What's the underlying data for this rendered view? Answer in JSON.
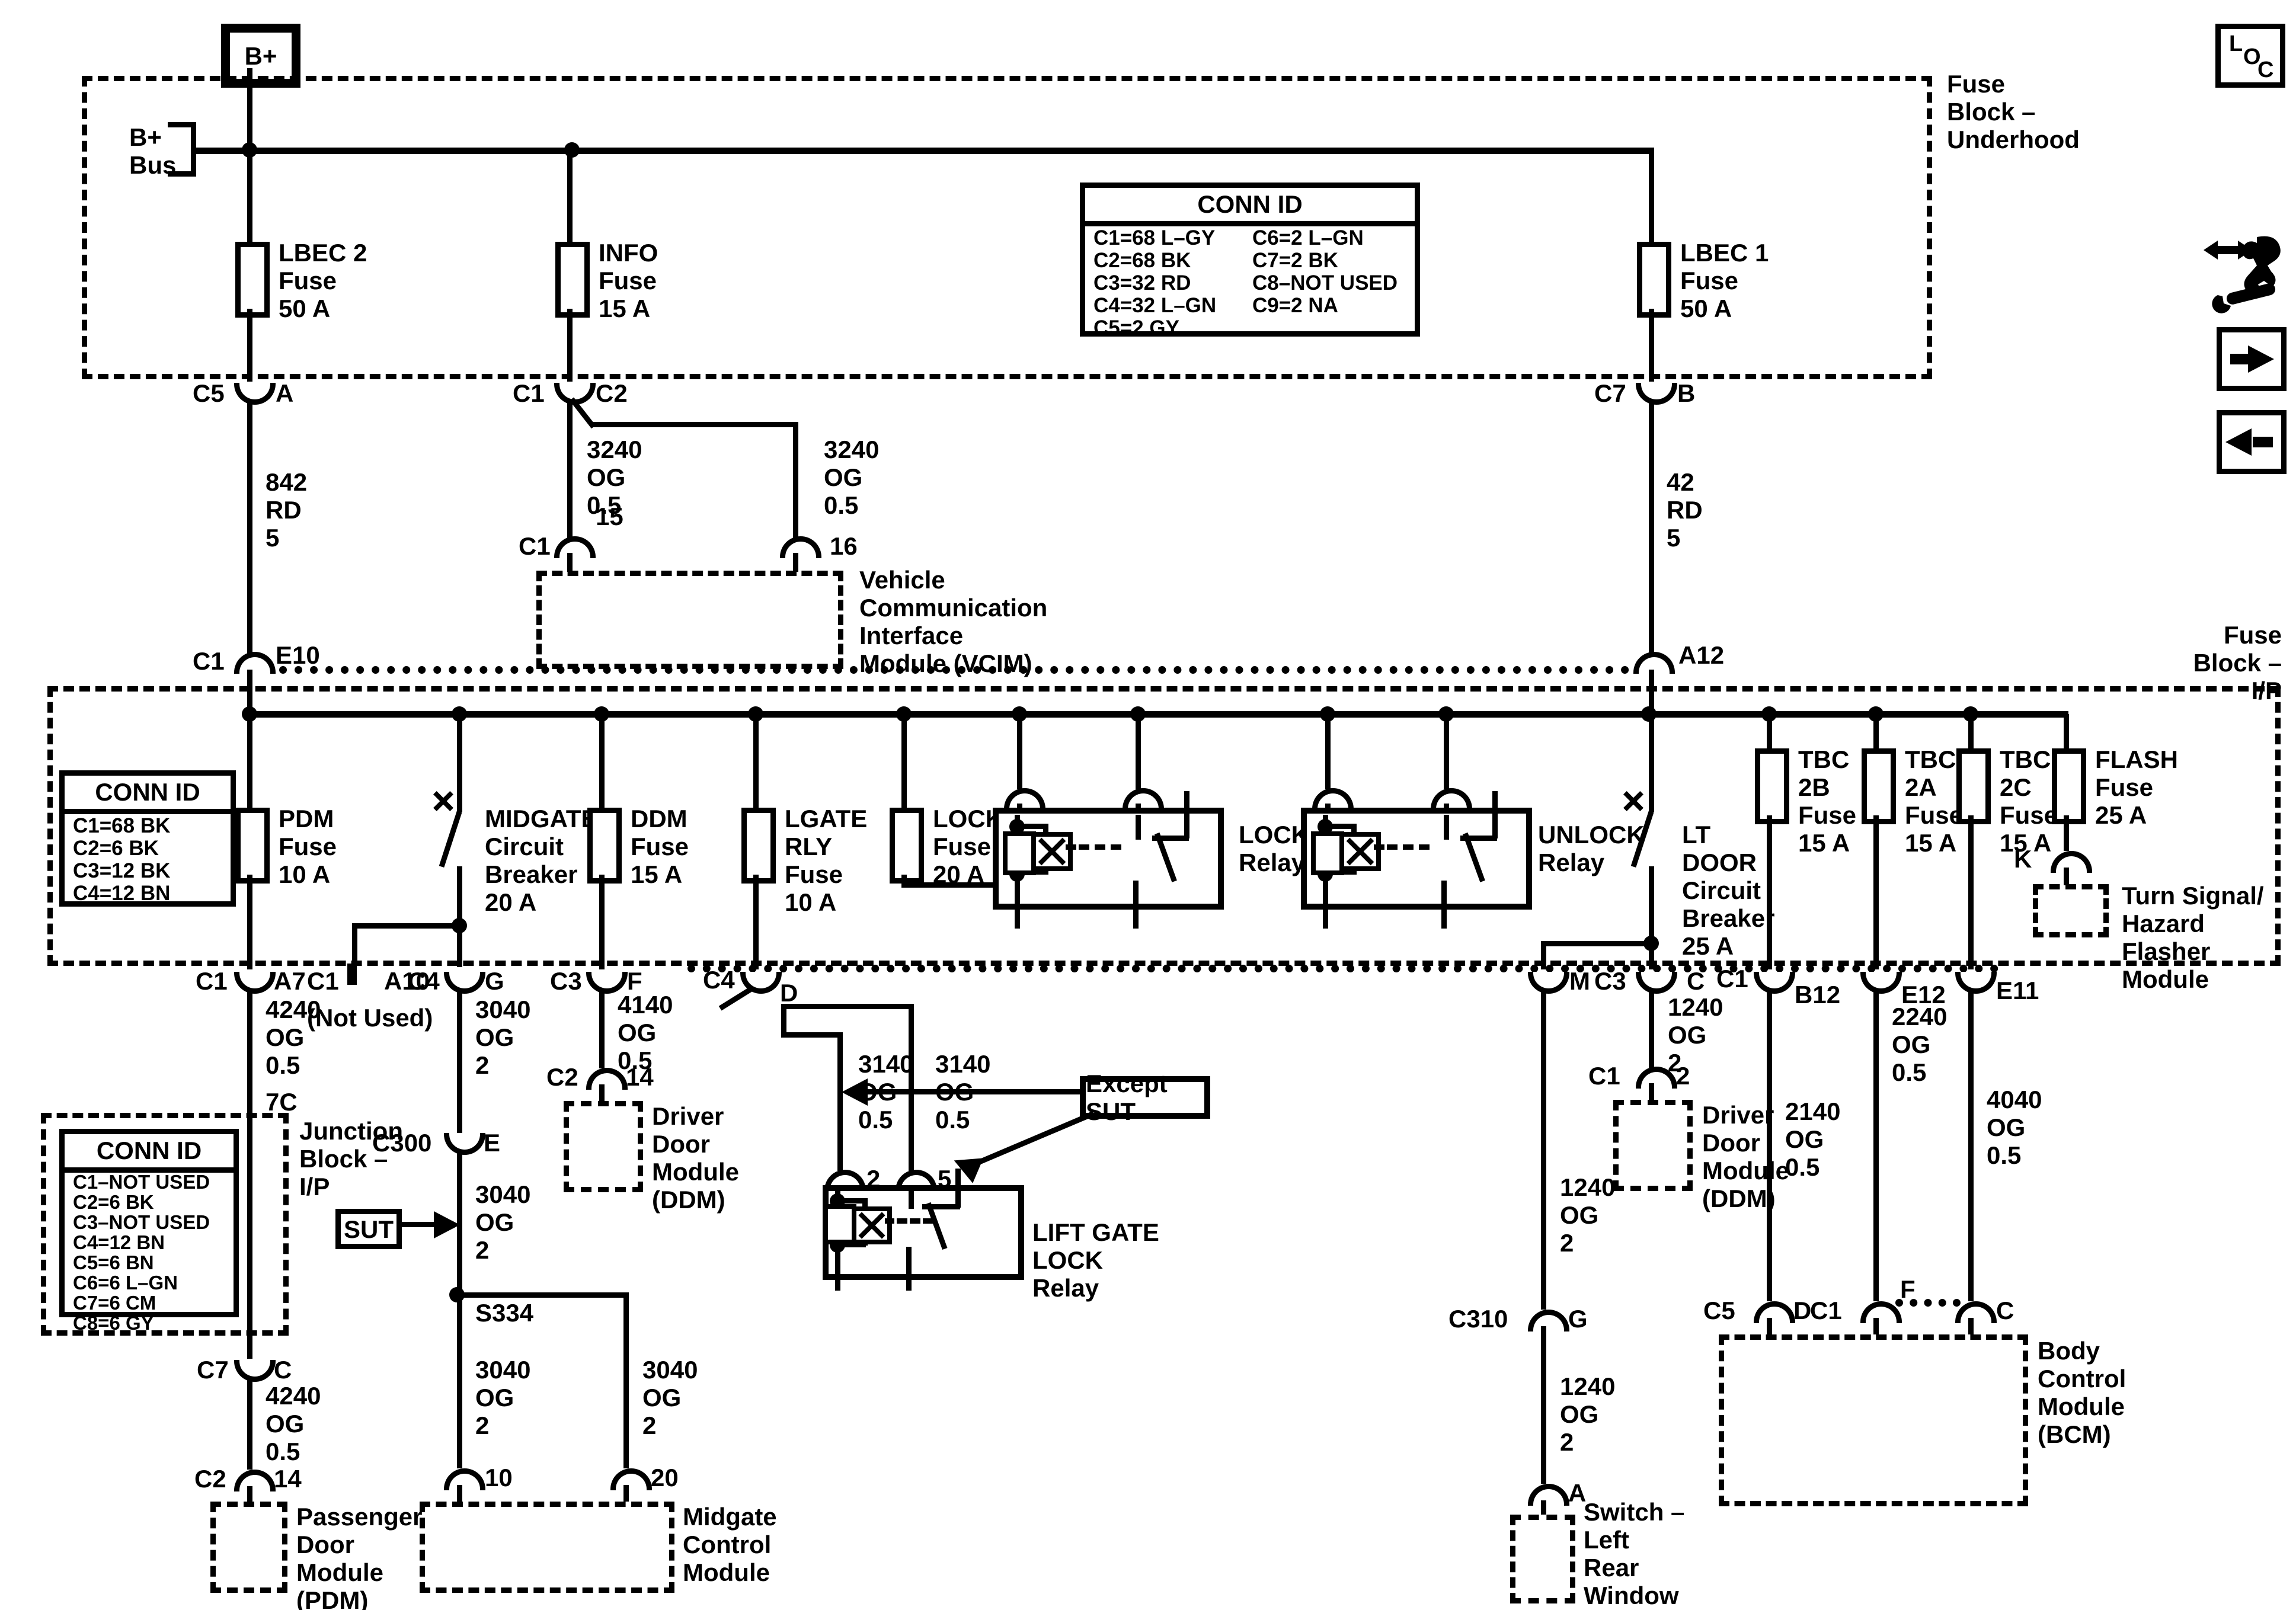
{
  "nav": {
    "loc_l": "L",
    "loc_o": "O",
    "loc_c": "C"
  },
  "underhood": {
    "bplus": "B+",
    "bus": "B+\nBus",
    "section": "Fuse\nBlock –\nUnderhood",
    "lbec2": "LBEC 2\nFuse\n50 A",
    "info": "INFO\nFuse\n15 A",
    "lbec1": "LBEC 1\nFuse\n50 A",
    "conn_id": {
      "title": "CONN ID",
      "col1": [
        "C1=68 L–GY",
        "C2=68 BK",
        "C3=32 RD",
        "C4=32 L–GN",
        "C5=2 GY"
      ],
      "col2": [
        "C6=2 L–GN",
        "C7=2 BK",
        "C8–NOT USED",
        "C9=2 NA"
      ]
    },
    "c5": "C5",
    "a": "A",
    "c1": "C1",
    "c2": "C2",
    "c7": "C7",
    "b": "B"
  },
  "feeds": {
    "w842": "842\nRD\n5",
    "w42": "42\nRD\n5",
    "c1": "C1",
    "e10": "E10",
    "a12": "A12"
  },
  "vcim": {
    "w_left": "3240\nOG\n0.5",
    "w_right": "3240\nOG\n0.5",
    "pin15": "15",
    "pin16": "16",
    "c1": "C1",
    "module": "Vehicle\nCommunication\nInterface\nModule (VCIM)"
  },
  "ip": {
    "section": "Fuse\nBlock –\nI/P",
    "conn_id": {
      "title": "CONN ID",
      "rows": [
        "C1=68 BK",
        "C2=6 BK",
        "C3=12 BK",
        "C4=12 BN"
      ]
    },
    "pdm_fuse": "PDM\nFuse\n10 A",
    "midgate_cb": "MIDGATE\nCircuit\nBreaker\n20 A",
    "ddm_fuse": "DDM\nFuse\n15 A",
    "lgate_fuse": "LGATE\nRLY\nFuse\n10 A",
    "locks_fuse": "LOCKS\nFuse\n20 A",
    "lock_relay": "LOCK\nRelay",
    "unlock_relay": "UNLOCK\nRelay",
    "ltdoor_cb": "LT\nDOOR\nCircuit\nBreaker\n25 A",
    "tbc2b": "TBC\n2B\nFuse\n15 A",
    "tbc2a": "TBC\n2A\nFuse\n15 A",
    "tbc2c": "TBC\n2C\nFuse\n15 A",
    "flash": "FLASH\nFuse\n25 A",
    "k": "K",
    "flasher_module": "Turn Signal/\nHazard Flasher\nModule"
  },
  "row": {
    "c1a": "C1",
    "a7": "A7",
    "c1b": "C1",
    "a10": "A10",
    "not_used": "(Not Used)",
    "c4a": "C4",
    "g": "G",
    "c3a": "C3",
    "f": "F",
    "c4b": "C4",
    "d": "D",
    "m": "M",
    "c3b": "C3",
    "c": "C",
    "c1c": "C1",
    "b12": "B12",
    "e12": "E12",
    "e11": "E11"
  },
  "left": {
    "w4240a": "4240\nOG\n0.5",
    "seg": "7C",
    "junction": "Junction\nBlock –\nI/P",
    "conn_id": {
      "title": "CONN ID",
      "rows": [
        "C1–NOT USED",
        "C2=6 BK",
        "C3–NOT USED",
        "C4=12 BN",
        "C5=6 BN",
        "C6=6 L–GN",
        "C7=6 CM",
        "C8=6 GY"
      ]
    },
    "c7": "C7",
    "c": "C",
    "w4240b": "4240\nOG\n0.5",
    "c2": "C2",
    "p14": "14",
    "pdm": "Passenger\nDoor\nModule\n(PDM)"
  },
  "midgate": {
    "w3040a": "3040\nOG\n2",
    "c300": "C300",
    "e": "E",
    "sut": "SUT",
    "w3040b": "3040\nOG\n2",
    "s334": "S334",
    "w3040c": "3040\nOG\n2",
    "w3040d": "3040\nOG\n2",
    "p10": "10",
    "p20": "20",
    "module": "Midgate\nControl\nModule"
  },
  "ddm_left": {
    "w4140": "4140\nOG\n0.5",
    "c2": "C2",
    "p14": "14",
    "module": "Driver\nDoor\nModule\n(DDM)"
  },
  "liftgate": {
    "except": "Except SUT",
    "w3140a": "3140\nOG\n0.5",
    "w3140b": "3140\nOG\n0.5",
    "p2": "2",
    "p5": "5",
    "relay": "LIFT GATE\nLOCK\nRelay"
  },
  "ddm_right": {
    "w1240": "1240\nOG\n2",
    "c1": "C1",
    "p2": "2",
    "module": "Driver\nDoor\nModule\n(DDM)"
  },
  "lrw": {
    "w1240a": "1240\nOG\n2",
    "c310": "C310",
    "g": "G",
    "w1240b": "1240\nOG\n2",
    "a": "A",
    "module": "Switch –\nLeft\nRear\nWindow"
  },
  "bcm": {
    "w2140": "2140\nOG\n0.5",
    "c5": "C5",
    "d": "D",
    "w2240": "2240\nOG\n0.5",
    "c1": "C1",
    "f": "F",
    "w4040": "4040\nOG\n0.5",
    "c": "C",
    "module": "Body\nControl\nModule\n(BCM)"
  }
}
